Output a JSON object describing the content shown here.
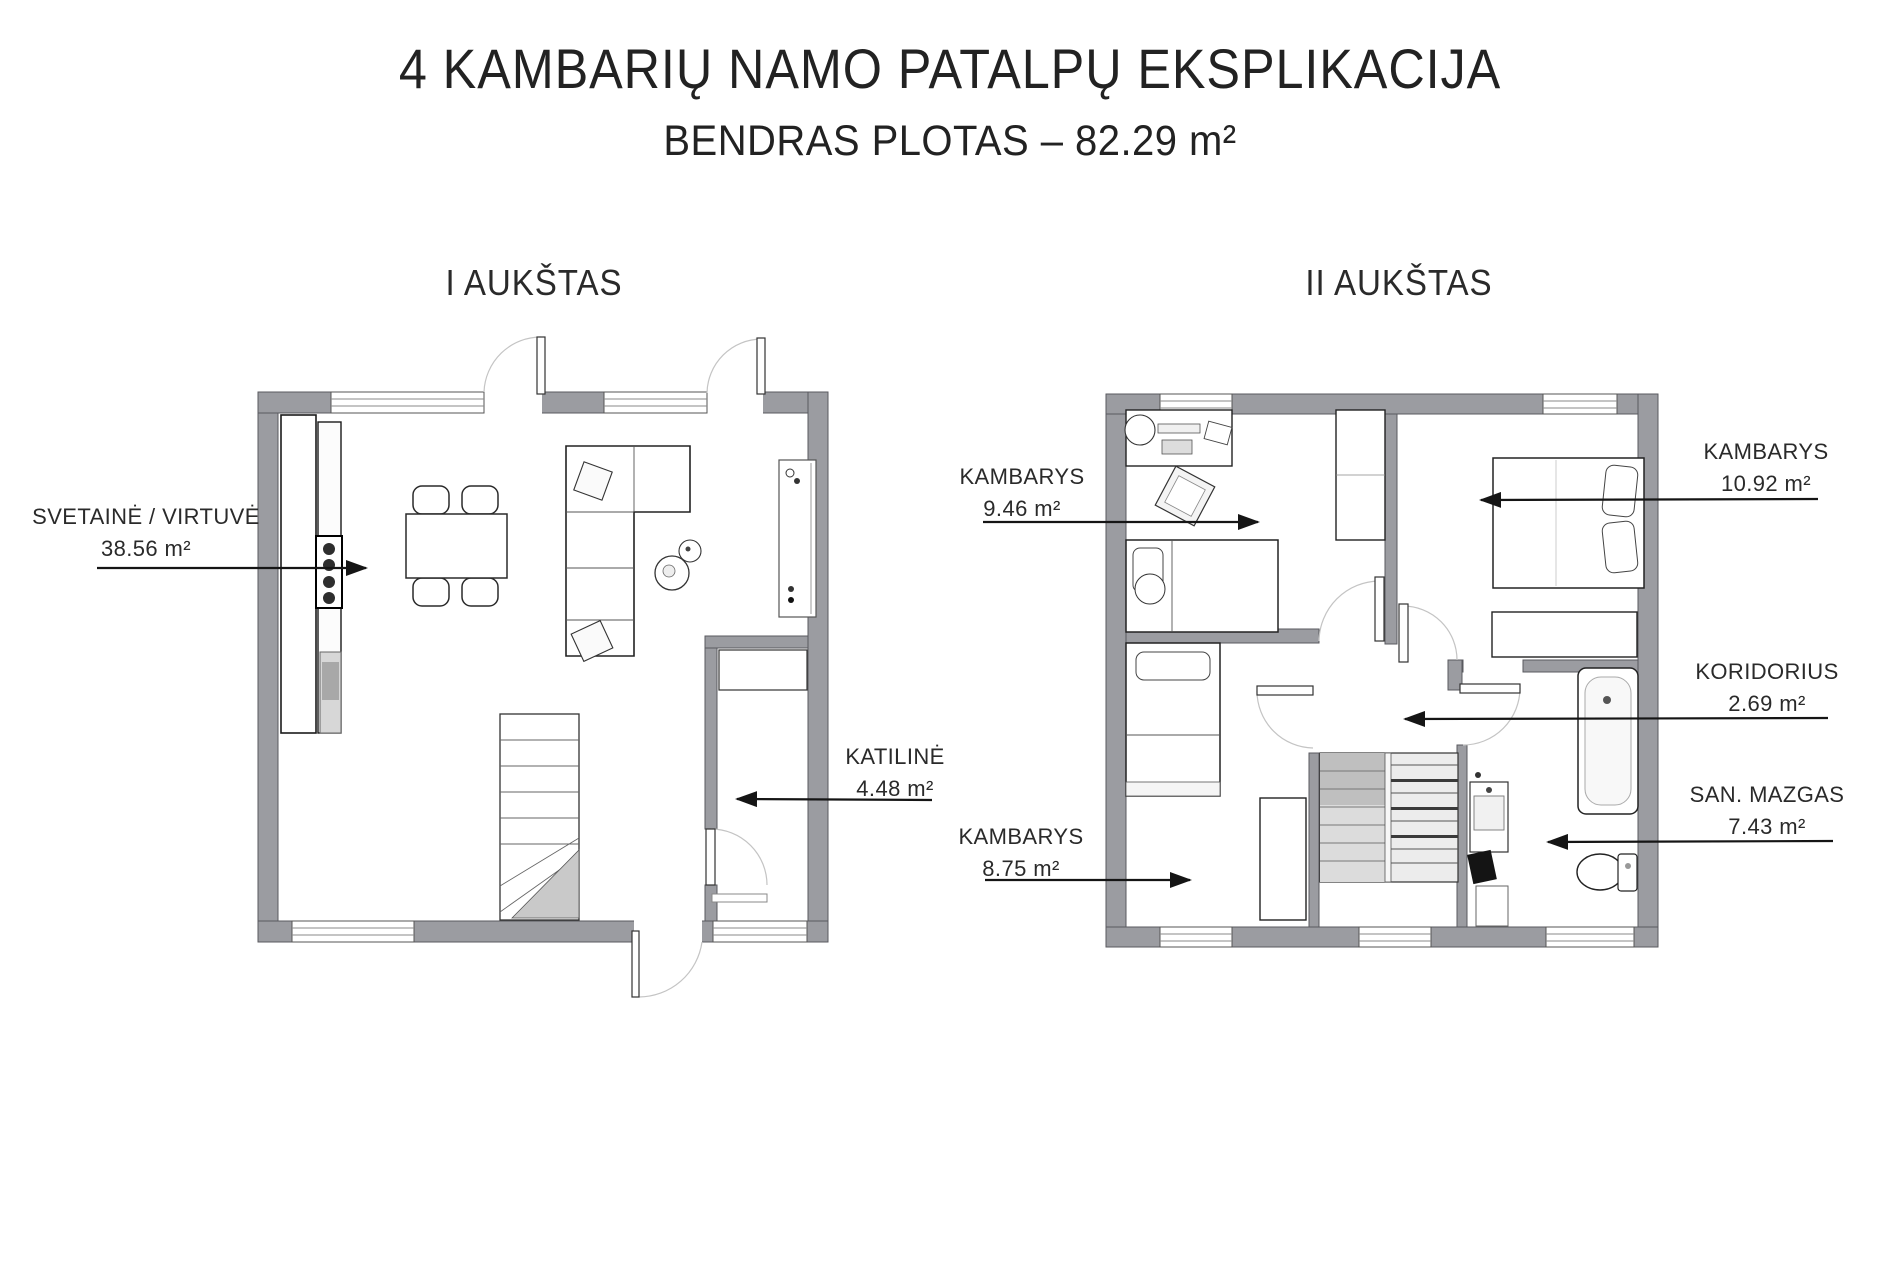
{
  "header": {
    "title": "4 KAMBARIŲ NAMO PATALPŲ EKSPLIKACIJA",
    "subtitle": "BENDRAS PLOTAS – 82.29 m²"
  },
  "floors": [
    {
      "label": "I AUKŠTAS",
      "rooms": [
        {
          "name": "SVETAINĖ / VIRTUVĖ",
          "area": "38.56 m²"
        },
        {
          "name": "KATILINĖ",
          "area": "4.48 m²"
        }
      ]
    },
    {
      "label": "II AUKŠTAS",
      "rooms": [
        {
          "name": "KAMBARYS",
          "area": "9.46 m²"
        },
        {
          "name": "KAMBARYS",
          "area": "10.92 m²"
        },
        {
          "name": "KORIDORIUS",
          "area": "2.69 m²"
        },
        {
          "name": "SAN. MAZGAS",
          "area": "7.43 m²"
        },
        {
          "name": "KAMBARYS",
          "area": "8.75 m²"
        }
      ]
    }
  ],
  "colors": {
    "wall": "#9b9ca1",
    "wall_outline": "#595a5f",
    "arrow": "#151515",
    "text": "#2a2a2a"
  }
}
